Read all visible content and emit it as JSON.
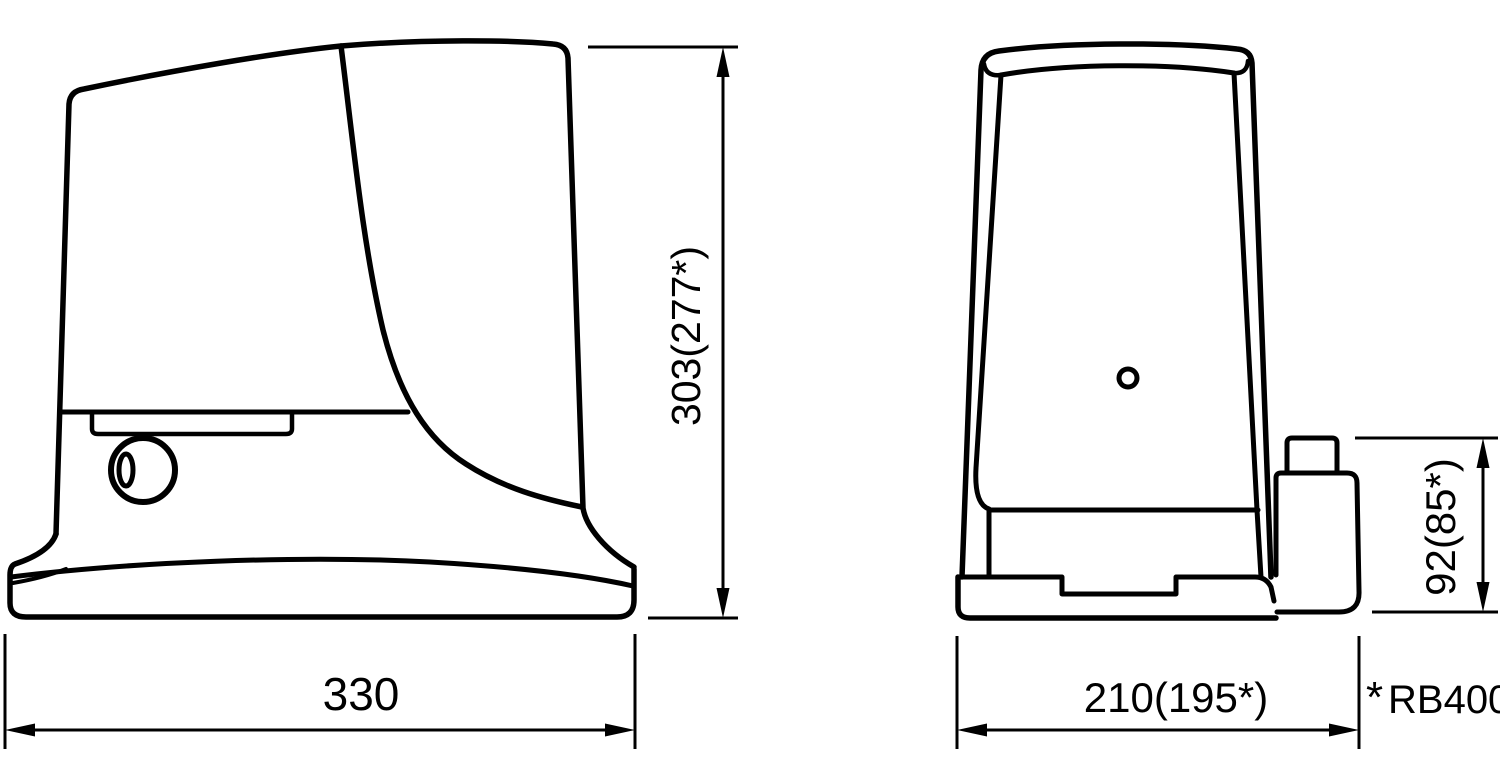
{
  "colors": {
    "line": "#000000",
    "background": "#ffffff"
  },
  "views": {
    "side": {
      "height_label": "303(277*)",
      "width_label": "330"
    },
    "front": {
      "width_label": "210(195*)",
      "housing_height_label": "92(85*)"
    }
  },
  "footnote": {
    "marker": "*",
    "label": "RB400"
  }
}
